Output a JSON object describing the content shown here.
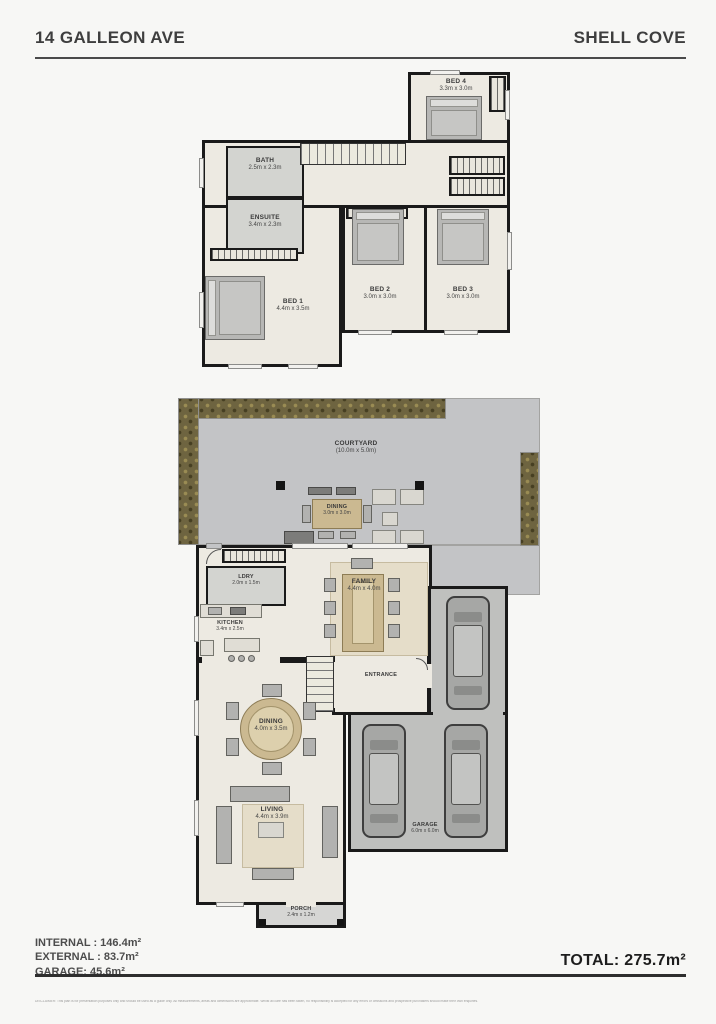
{
  "header": {
    "address": "14 GALLEON AVE",
    "suburb": "SHELL COVE"
  },
  "upper": {
    "bed4": {
      "name": "BED 4",
      "dims": "3.3m x 3.0m"
    },
    "bath": {
      "name": "BATH",
      "dims": "2.5m x 2.3m"
    },
    "ensuite": {
      "name": "ENSUITE",
      "dims": "3.4m x 2.3m"
    },
    "bed1": {
      "name": "BED 1",
      "dims": "4.4m x 3.5m"
    },
    "bed2": {
      "name": "BED 2",
      "dims": "3.0m x 3.0m"
    },
    "bed3": {
      "name": "BED 3",
      "dims": "3.0m x 3.0m"
    }
  },
  "ground": {
    "courtyard": {
      "name": "COURTYARD",
      "dims": "(10.0m x 5.0m)"
    },
    "alfresco": {
      "name": "DINING",
      "dims": "3.0m x 3.0m"
    },
    "ldry": {
      "name": "LDRY",
      "dims": "2.0m x 1.5m"
    },
    "kitchen": {
      "name": "KITCHEN",
      "dims": "3.4m x 2.5m"
    },
    "family": {
      "name": "FAMILY",
      "dims": "4.4m x 4.0m"
    },
    "entrance": {
      "name": "ENTRANCE"
    },
    "dining": {
      "name": "DINING",
      "dims": "4.0m x 3.5m"
    },
    "living": {
      "name": "LIVING",
      "dims": "4.4m x 3.9m"
    },
    "porch": {
      "name": "PORCH",
      "dims": "2.4m x 1.2m"
    },
    "garage": {
      "name": "GARAGE",
      "dims": "6.0m x 6.0m"
    }
  },
  "summary": {
    "internal": "INTERNAL : 146.4m²",
    "external": "EXTERNAL : 83.7m²",
    "garage": "GARAGE: 45.6m²",
    "total": "TOTAL: 275.7m²"
  },
  "footer": {
    "disclaimer": "DISCLAIMER: This plan is for presentation purposes only and should be used as a guide only. All measurements, areas and dimensions are approximate. Whilst all care has been taken, no responsibility is accepted for any errors or omissions and prospective purchasers should make their own enquiries."
  },
  "colors": {
    "wall": "#1a1a1a",
    "floor": "#edeae2",
    "wet_area": "#d3d4d0",
    "paving": "#c3c4c6",
    "garage_floor": "#bfc0be",
    "garden": "#6e6440"
  }
}
